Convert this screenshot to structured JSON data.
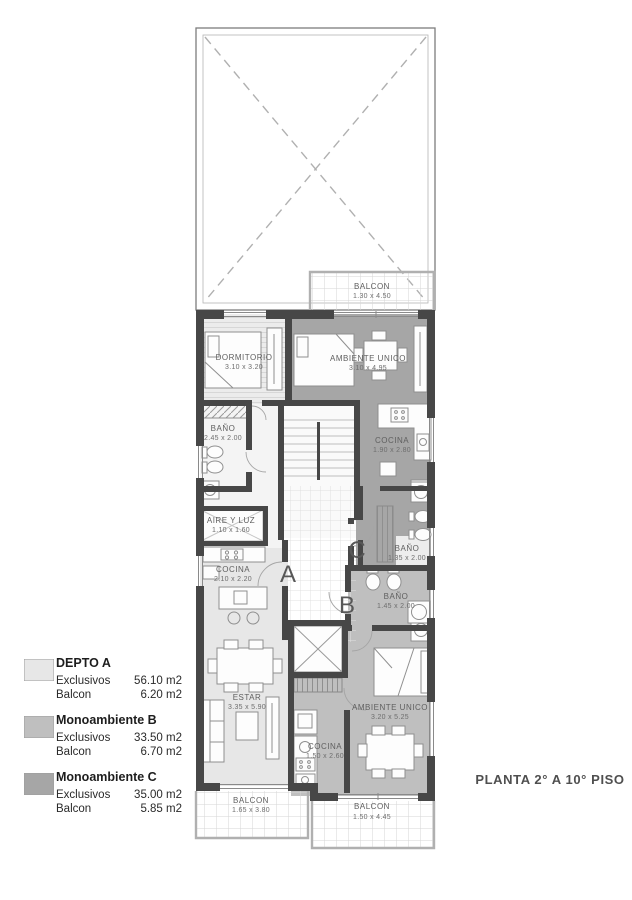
{
  "title": {
    "text": "PLANTA 2° A 10° PISO"
  },
  "colors": {
    "unit_a": "#e7e7e7",
    "unit_b": "#bfbfbf",
    "unit_c": "#a6a6a6",
    "wall": "#474747"
  },
  "rooms": {
    "dormitorio": {
      "label": "DORMITORIO",
      "dims": "3.10 x 3.20"
    },
    "ambiente_unico_c": {
      "label": "AMBIENTE UNICO",
      "dims": "3.10 x 4.95"
    },
    "bano_a": {
      "label": "BAÑO",
      "dims": "2.45 x 2.00"
    },
    "cocina_c": {
      "label": "COCINA",
      "dims": "1.90 x 2.80"
    },
    "aire_y_luz": {
      "label": "AIRE Y LUZ",
      "dims": "1.10 x 1.60"
    },
    "bano_c": {
      "label": "BAÑO",
      "dims": "1.35 x 2.00"
    },
    "bano_b": {
      "label": "BAÑO",
      "dims": "1.45 x 2.00"
    },
    "cocina_a": {
      "label": "COCINA",
      "dims": "2.10 x 2.20"
    },
    "estar": {
      "label": "ESTAR",
      "dims": "3.35 x 5.90"
    },
    "cocina_b": {
      "label": "COCINA",
      "dims": "1.50 x 2.60"
    },
    "ambiente_unico_b": {
      "label": "AMBIENTE UNICO",
      "dims": "3.20 x 5.25"
    },
    "balcon_top": {
      "label": "BALCON",
      "dims": "1.30 x 4.50"
    },
    "balcon_bottom_left": {
      "label": "BALCON",
      "dims": "1.65 x 3.80"
    },
    "balcon_bottom_right": {
      "label": "BALCON",
      "dims": "1.50 x 4.45"
    }
  },
  "unit_markers": {
    "a": "A",
    "b": "B",
    "c": "C"
  },
  "legend": {
    "items": [
      {
        "name": "DEPTO A",
        "color": "#e7e7e7",
        "rows": [
          {
            "label": "Exclusivos",
            "value": "56.10 m2"
          },
          {
            "label": "Balcon",
            "value": "6.20 m2"
          }
        ]
      },
      {
        "name": "Monoambiente B",
        "color": "#bfbfbf",
        "rows": [
          {
            "label": "Exclusivos",
            "value": "33.50 m2"
          },
          {
            "label": "Balcon",
            "value": "6.70 m2"
          }
        ]
      },
      {
        "name": "Monoambiente C",
        "color": "#a6a6a6",
        "rows": [
          {
            "label": "Exclusivos",
            "value": "35.00 m2"
          },
          {
            "label": "Balcon",
            "value": "5.85 m2"
          }
        ]
      }
    ]
  }
}
